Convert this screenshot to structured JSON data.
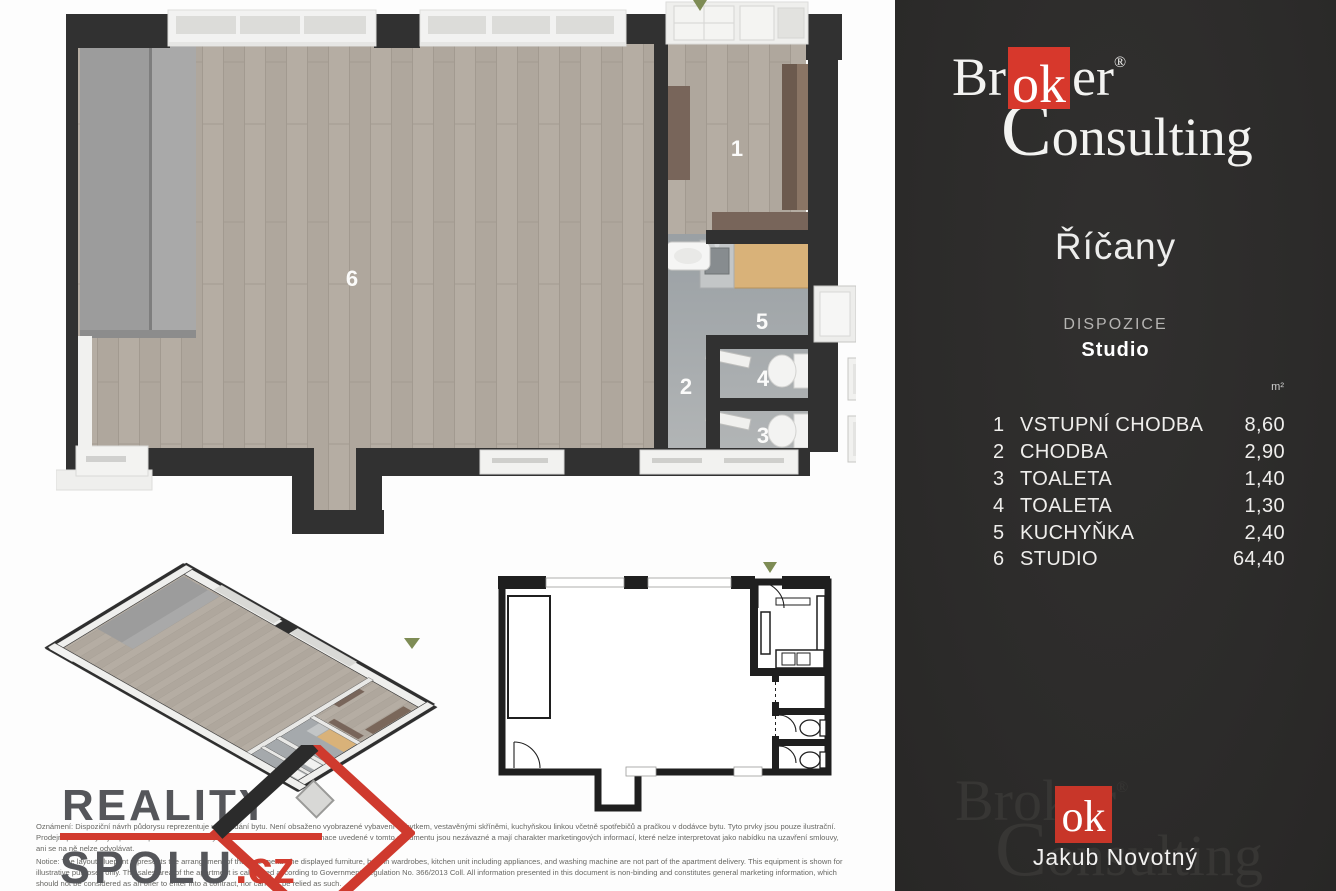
{
  "side_panel": {
    "brand": {
      "pre": "Br",
      "ok": "ok",
      "post": "er",
      "reg": "®",
      "line2": "Consulting"
    },
    "city": "Říčany",
    "section_label": "DISPOZICE",
    "layout_type": "Studio",
    "unit_label": "m²",
    "rooms": [
      {
        "num": "1",
        "name": "VSTUPNÍ CHODBA",
        "area": "8,60"
      },
      {
        "num": "2",
        "name": "CHODBA",
        "area": "2,90"
      },
      {
        "num": "3",
        "name": "TOALETA",
        "area": "1,40"
      },
      {
        "num": "4",
        "name": "TOALETA",
        "area": "1,30"
      },
      {
        "num": "5",
        "name": "KUCHYŇKA",
        "area": "2,40"
      },
      {
        "num": "6",
        "name": "STUDIO",
        "area": "64,40"
      }
    ],
    "agent_name": "Jakub Novotný"
  },
  "floor_plan": {
    "labels": {
      "r1": "1",
      "r2": "2",
      "r3": "3",
      "r4": "4",
      "r5": "5",
      "r6": "6"
    }
  },
  "footer": {
    "brand_word1": "REALITY",
    "brand_word2": "SPOLU",
    "brand_tld": ".cz",
    "disclaimer_cz": [
      "Oznámení: Dispoziční návrh půdorysu reprezentuje uspořádání bytu. Není obsaženo vyobrazené vybavení nábytkem, vestavěnými skříněmi, kuchyňskou linkou včetně spotřebičů a pračkou v dodávce bytu. Tyto prvky jsou pouze ilustrační.",
      "Prodejní plocha bytu je spočtena podle nařízení vlády č. 366/2013 Sb. Veškeré informace uvedené v tomto dokumentu jsou nezávazné a mají charakter marketingových informací, které nelze interpretovat jako nabídku na uzavření smlouvy,",
      "ani se na ně nelze odvolávat."
    ],
    "disclaimer_en": [
      "Notice: The layout blueprint represents the arrangement of the apartment. The displayed furniture, built-in wardrobes, kitchen unit including appliances, and washing machine are not part of the apartment delivery. This equipment is shown for",
      "illustrative purposes only. The sales area of the apartment is calculated according to Government Regulation No. 366/2013 Coll. All information presented in this document is non-binding and constitutes general marketing information, which",
      "should not be considered as an offer to enter into a contract, nor can this be relied as such."
    ]
  },
  "colors": {
    "brand_red": "#d7382c",
    "panel_bg": "#2d2c2b",
    "wall": "#313131",
    "wood_floor": "#b4aca2",
    "service_floor": "#a4a8ab",
    "accent_green": "#7e8c55"
  }
}
